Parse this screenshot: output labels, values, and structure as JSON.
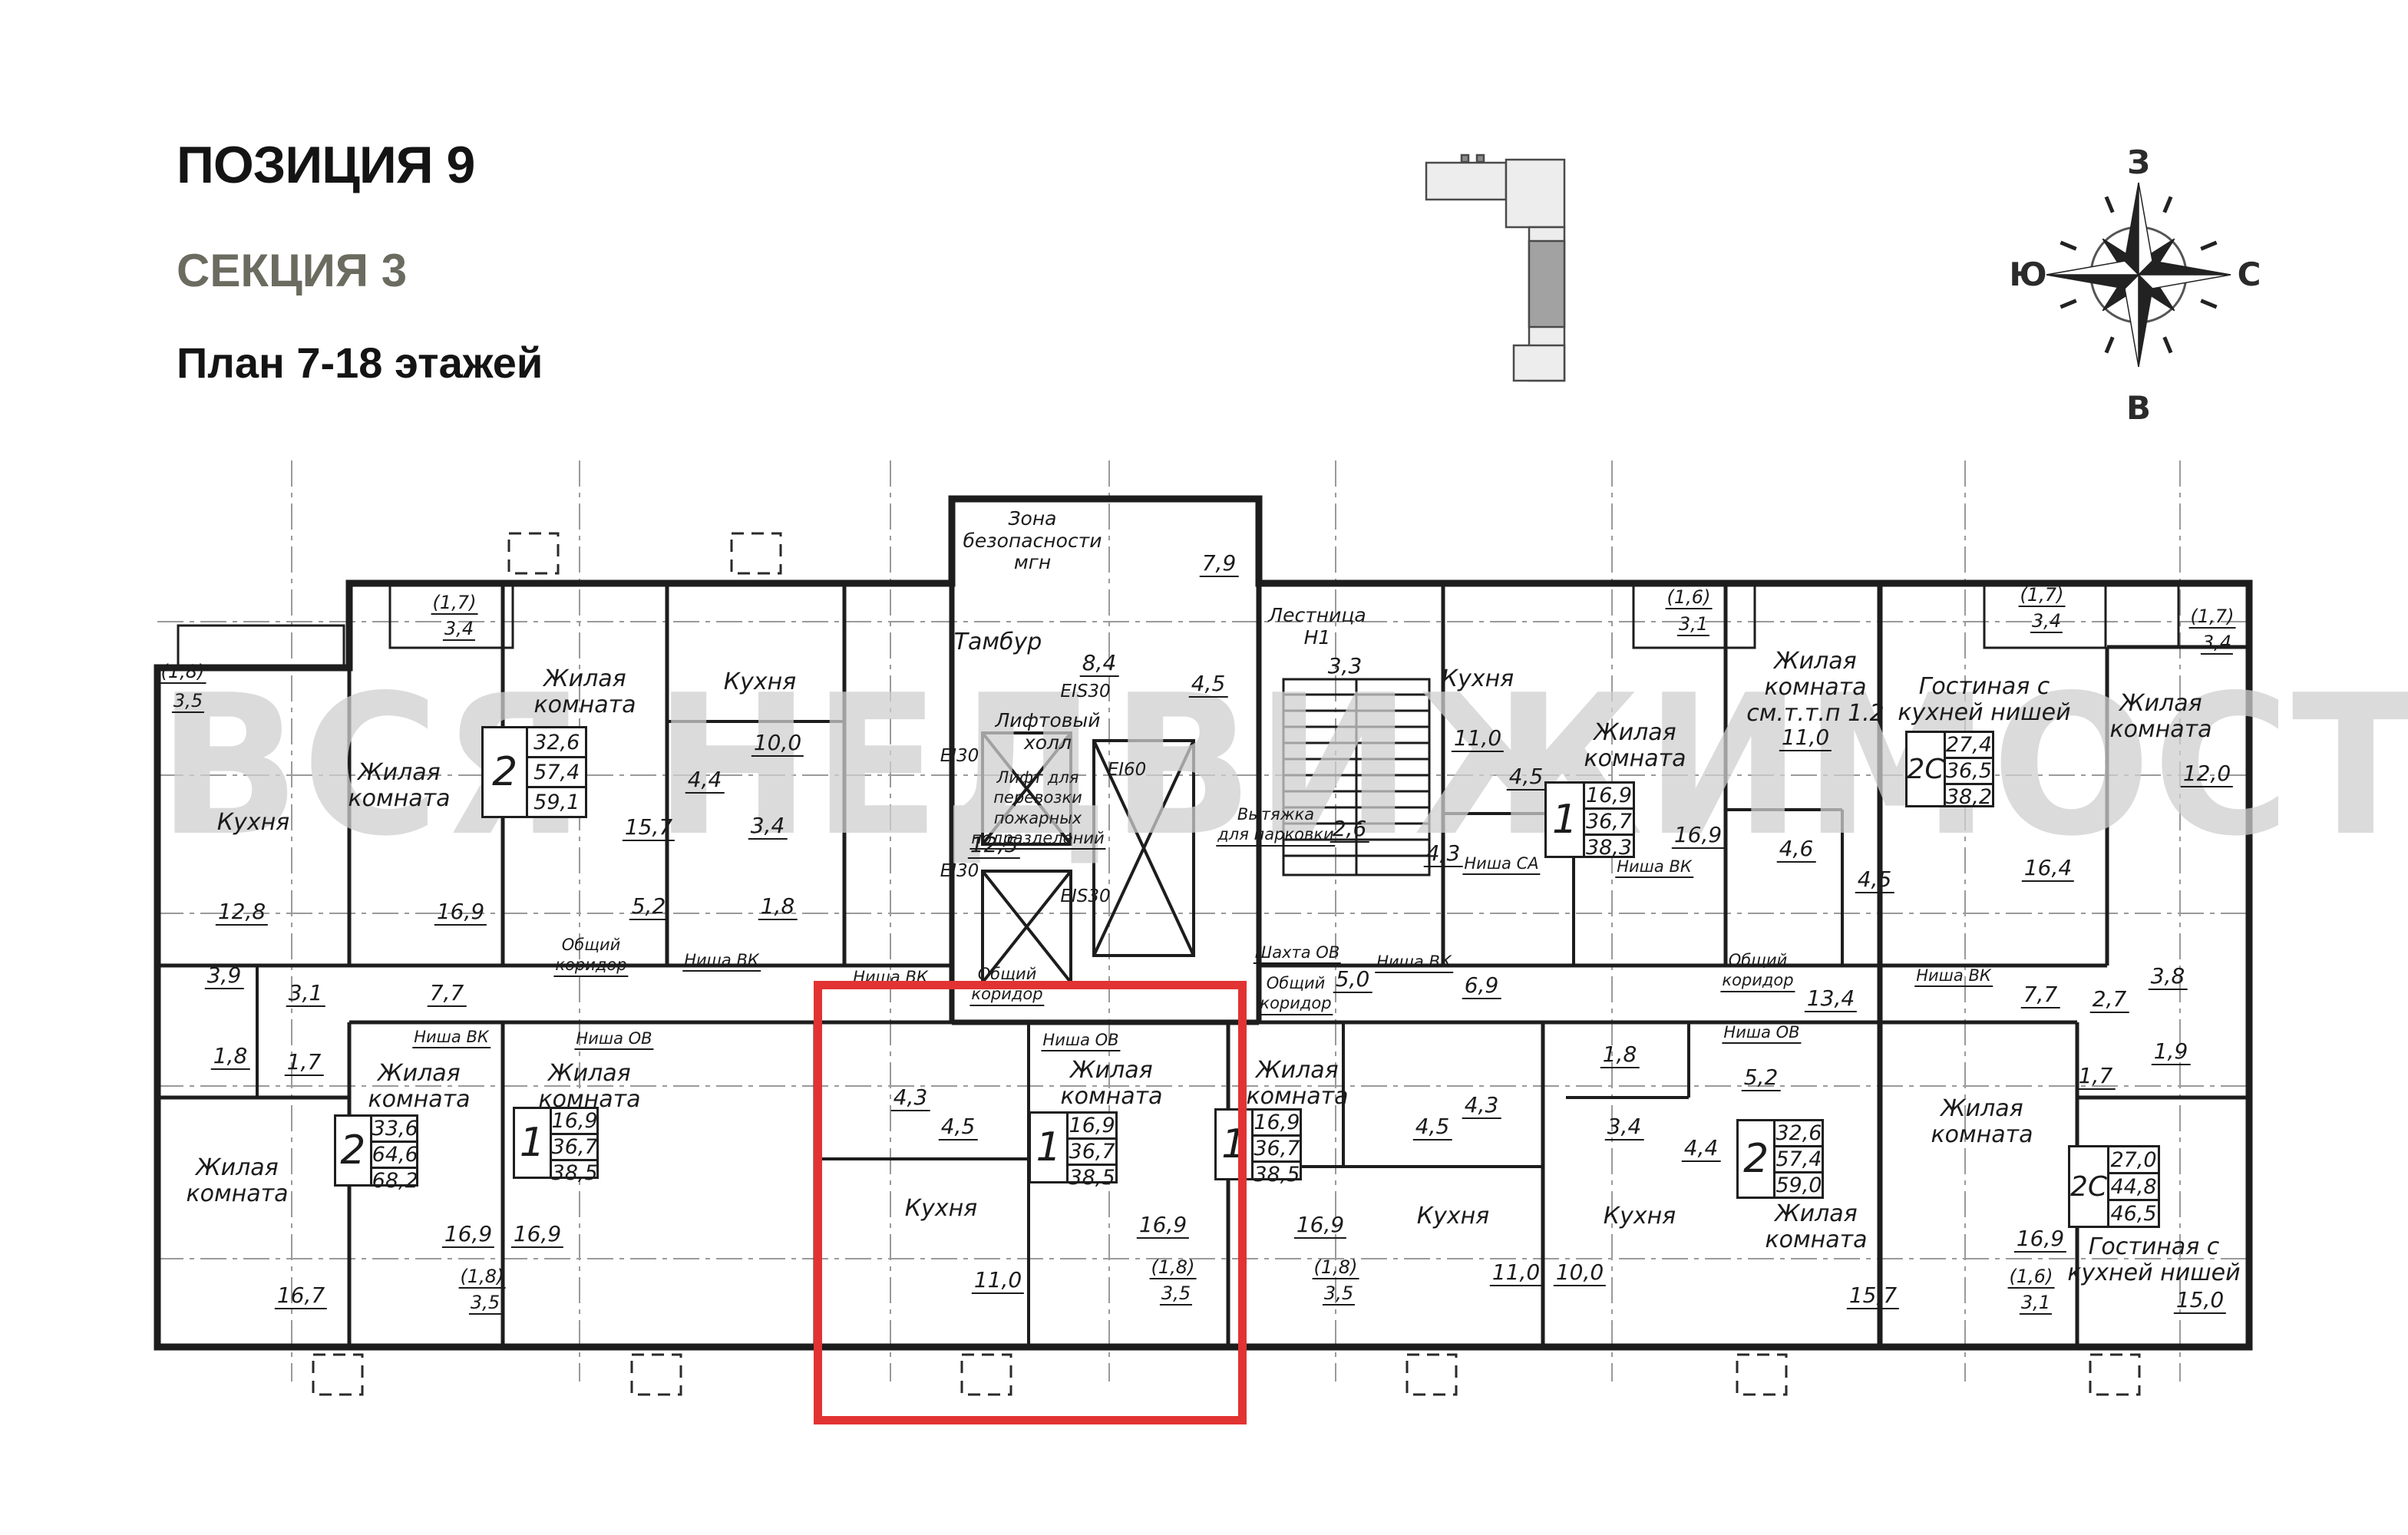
{
  "header": {
    "position": "ПОЗИЦИЯ 9",
    "section": "СЕКЦИЯ 3",
    "floors": "План 7-18 этажей"
  },
  "compass": {
    "w": "З",
    "n": "С",
    "e": "В",
    "s": "Ю"
  },
  "watermark": "ВСЯ НЕДВИЖИМОСТЬ",
  "rooms": {
    "kitchen": "Кухня",
    "living": "Жилая\nкомната",
    "living_ref": "Жилая\nкомната\nсм.т.т.п 1.2",
    "guest": "Гостиная с\nкухней нишей",
    "zona": "Зона\nбезопасности\nмгн",
    "tambur": "Тамбур",
    "stairs": "Лестница\nН1",
    "lift_hall": "Лифтовый\nхолл",
    "lift_fire": "Лифт для\nперевозки\nпожарных\nподразделений",
    "vent": "Вытяжка\nдля парковки",
    "shaft": "Шахта ОВ",
    "corridor": "Общий\nкоридор",
    "niche_vk": "Ниша ВК",
    "niche_ov": "Ниша ОВ",
    "niche_sa": "Ниша СА",
    "ei30": "EI30",
    "ei60": "EI60",
    "eis30": "EIS30"
  },
  "areas": {
    "a1_7": "1,7",
    "a1_8": "1,8",
    "a1_9": "1,9",
    "a2_6": "2,6",
    "a2_7": "2,7",
    "a3_1": "3,1",
    "a3_3": "3,3",
    "a3_4": "3,4",
    "a3_5": "3,5",
    "a3_8": "3,8",
    "a3_9": "3,9",
    "a4_3": "4,3",
    "a4_4": "4,4",
    "a4_5": "4,5",
    "a4_6": "4,6",
    "a5_0": "5,0",
    "a5_2": "5,2",
    "a6_9": "6,9",
    "a7_7": "7,7",
    "a7_9": "7,9",
    "a8_4": "8,4",
    "a10_0": "10,0",
    "a11_0": "11,0",
    "a12_0": "12,0",
    "a12_5": "12,5",
    "a12_8": "12,8",
    "a13_4": "13,4",
    "a15_0": "15,0",
    "a15_7": "15,7",
    "a16_4": "16,4",
    "a16_7": "16,7",
    "a16_9": "16,9",
    "p1_6": "(1,6)",
    "p1_7": "(1,7)",
    "p1_8": "(1,8)"
  },
  "apartments": [
    {
      "type": "2",
      "living": "32,6",
      "area": "57,4",
      "total": "59,1"
    },
    {
      "type": "1",
      "living": "16,9",
      "area": "36,7",
      "total": "38,3"
    },
    {
      "type": "2С",
      "living": "27,4",
      "area": "36,5",
      "total": "38,2"
    },
    {
      "type": "2",
      "living": "33,6",
      "area": "64,6",
      "total": "68,2"
    },
    {
      "type": "1",
      "living": "16,9",
      "area": "36,7",
      "total": "38,5"
    },
    {
      "type": "1",
      "living": "16,9",
      "area": "36,7",
      "total": "38,5"
    },
    {
      "type": "1",
      "living": "16,9",
      "area": "36,7",
      "total": "38,5"
    },
    {
      "type": "2",
      "living": "32,6",
      "area": "57,4",
      "total": "59,0"
    },
    {
      "type": "2С",
      "living": "27,0",
      "area": "44,8",
      "total": "46,5"
    }
  ]
}
